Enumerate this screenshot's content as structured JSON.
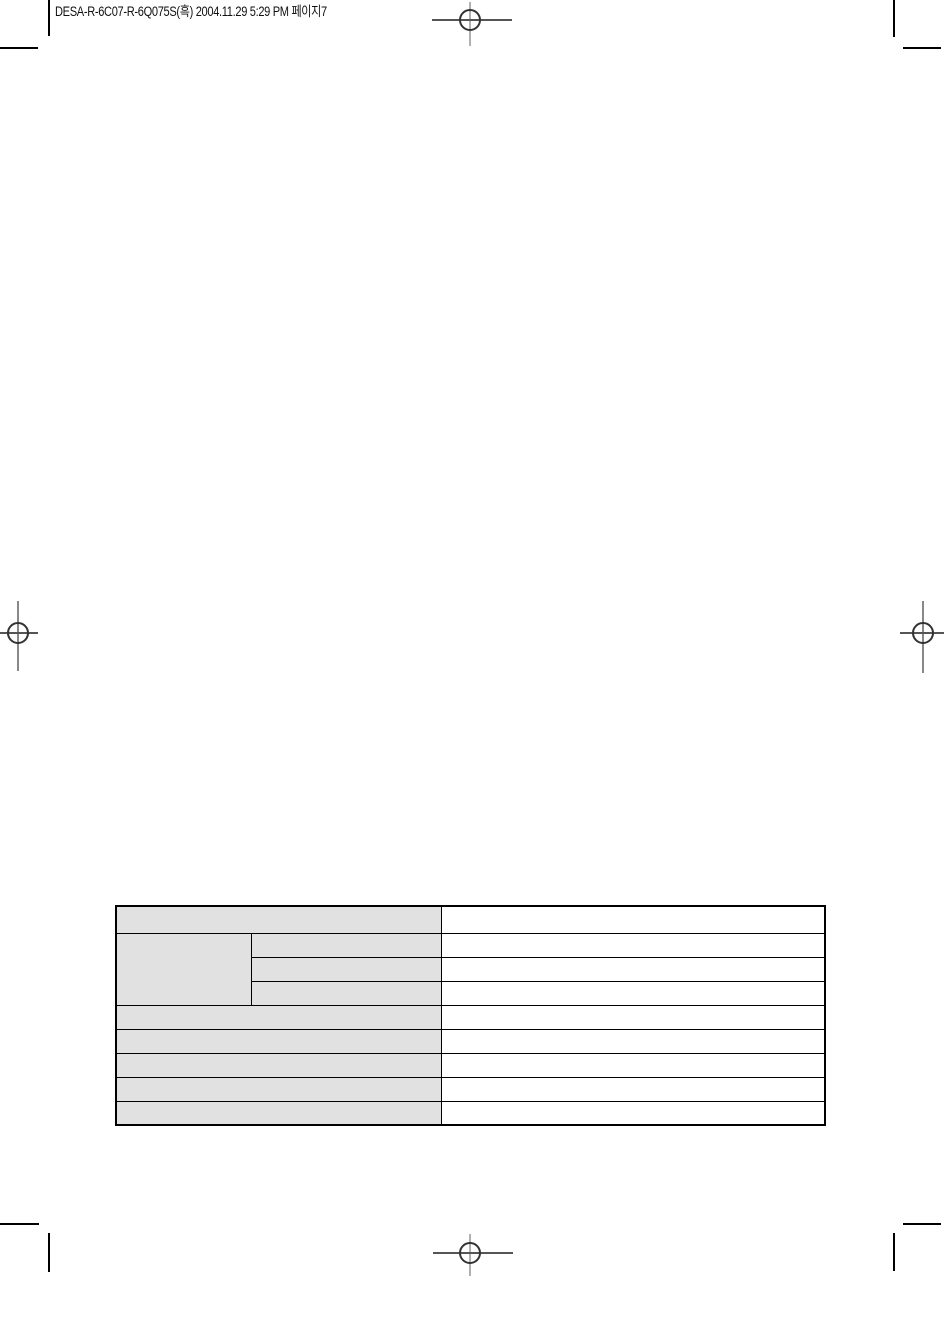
{
  "page": {
    "header_text": "DESA-R-6C07-R-6Q075S(흑) 2004.11.29 5:29 PM 페이지7"
  },
  "colors": {
    "table_label_bg": "#e1e1e1",
    "table_border": "#000000",
    "crop_mark": "#000000",
    "registration_circle": "#333333",
    "registration_line": "#555555"
  },
  "table": {
    "rows": [
      {
        "label": "",
        "value": ""
      },
      {
        "group": "",
        "label": "",
        "value": ""
      },
      {
        "label": "",
        "value": ""
      },
      {
        "label": "",
        "value": ""
      },
      {
        "label": "",
        "value": ""
      },
      {
        "label": "",
        "value": ""
      },
      {
        "label": "",
        "value": ""
      },
      {
        "label": "",
        "value": ""
      },
      {
        "label": "",
        "value": ""
      }
    ]
  }
}
